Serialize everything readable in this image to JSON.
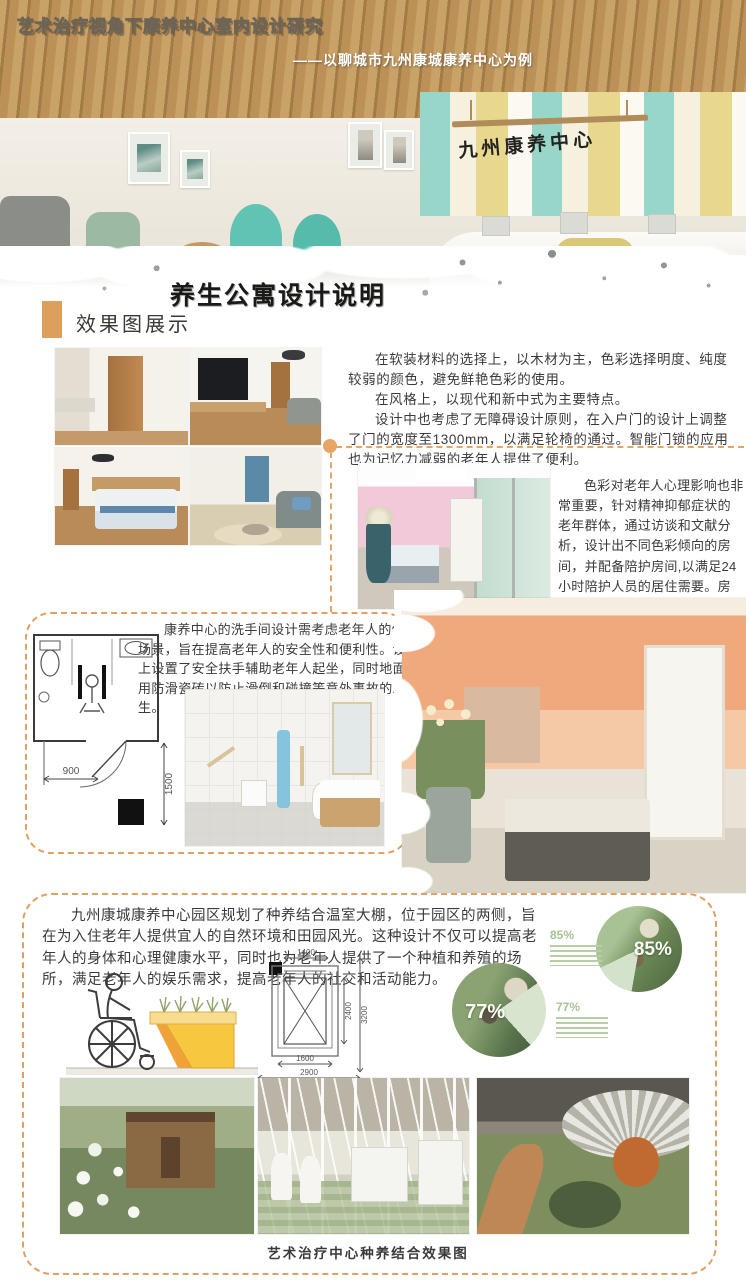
{
  "poster": {
    "title": "艺术治疗视角下康养中心室内设计研究",
    "subtitle": "——以聊城市九州康城康养中心为例",
    "lobby_sign": "九州康养中心",
    "brush_heading": "养生公寓设计说明",
    "accent_color": "#dd9f5e",
    "dash_color": "#dfa061"
  },
  "renderings_section": {
    "heading": "效果图展示",
    "p1": "在软装材料的选择上，以木材为主，色彩选择明度、纯度较弱的颜色，避免鲜艳色彩的使用。",
    "p2": "在风格上，以现代和新中式为主要特点。",
    "p3": "设计中也考虑了无障碍设计原则，在入户门的设计上调整了门的宽度至1300mm，以满足轮椅的通过。智能门锁的应用也为记忆力减弱的老年人提供了便利。"
  },
  "color_section": {
    "p1": "色彩对老年人心理影响也非常重要，针对精神抑郁症状的老年群体，通过访谈和文献分析，设计出不同色彩倾向的房间，并配备陪护房间,以满足24小时陪护人员的居住需要。房间内的设计采用隔断，使用玻璃材料便于陪护人员随时观察。"
  },
  "bathroom_section": {
    "p1": "康养中心的洗手间设计需考虑老年人的使用场景，旨在提高老年人的安全性和便利性。设计上设置了安全扶手辅助老年人起坐，同时地面采用防滑瓷砖以防止滑倒和碰撞等意外事故的发生。",
    "plan": {
      "width": "900",
      "height": "1500"
    }
  },
  "garden_section": {
    "p1": "九州康城康养中心园区规划了种养结合温室大棚，位于园区的两侧，旨在为入住老年人提供宜人的自然环境和田园风光。这种设计不仅可以提高老年人的身体和心理健康水平，同时也为老年人提供了一个种植和养殖的场所，满足老年人的娱乐需求，提高老年人的社交和活动能力。",
    "caption": "艺术治疗中心种养结合效果图",
    "elevator_plan": {
      "top": "1400",
      "inner_height": "2400",
      "outer_height": "3200",
      "inner_width": "1600",
      "outer_width": "2900"
    },
    "stats": [
      {
        "value": "85%"
      },
      {
        "value": "77%"
      }
    ]
  },
  "chart_data": [
    {
      "type": "pie",
      "title": "85%",
      "values": [
        85,
        15
      ],
      "labels": [
        "比例",
        "其余"
      ]
    },
    {
      "type": "pie",
      "title": "77%",
      "values": [
        77,
        23
      ],
      "labels": [
        "比例",
        "其余"
      ]
    }
  ]
}
